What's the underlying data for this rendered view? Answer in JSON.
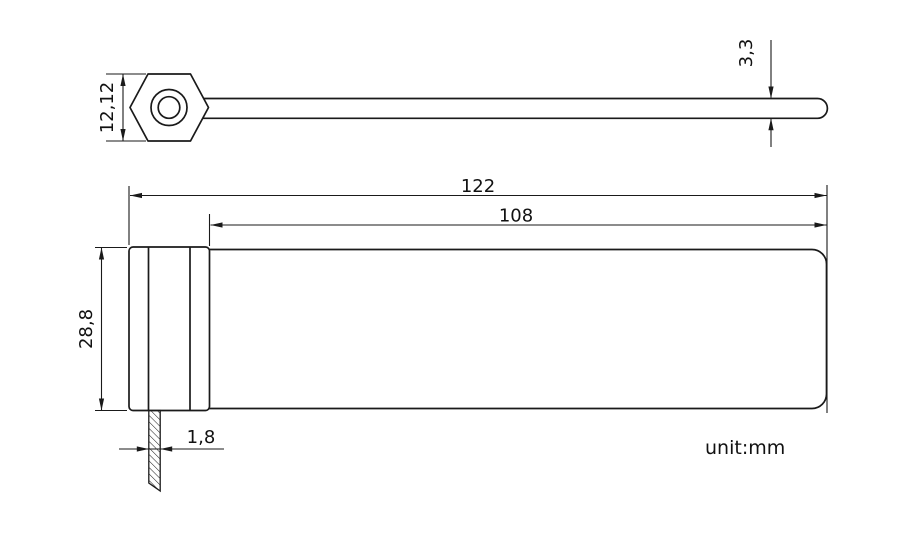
{
  "drawing": {
    "unit_note": "unit:mm",
    "colors": {
      "line": "#1a1a1a",
      "background": "#ffffff"
    },
    "side_view": {
      "head_height_mm": "12,12",
      "strap_end_thickness_mm": "3,3"
    },
    "plan_view": {
      "overall_length_mm": "122",
      "strap_length_mm": "108",
      "overall_width_mm": "28,8",
      "tail_width_mm": "1,8"
    }
  }
}
